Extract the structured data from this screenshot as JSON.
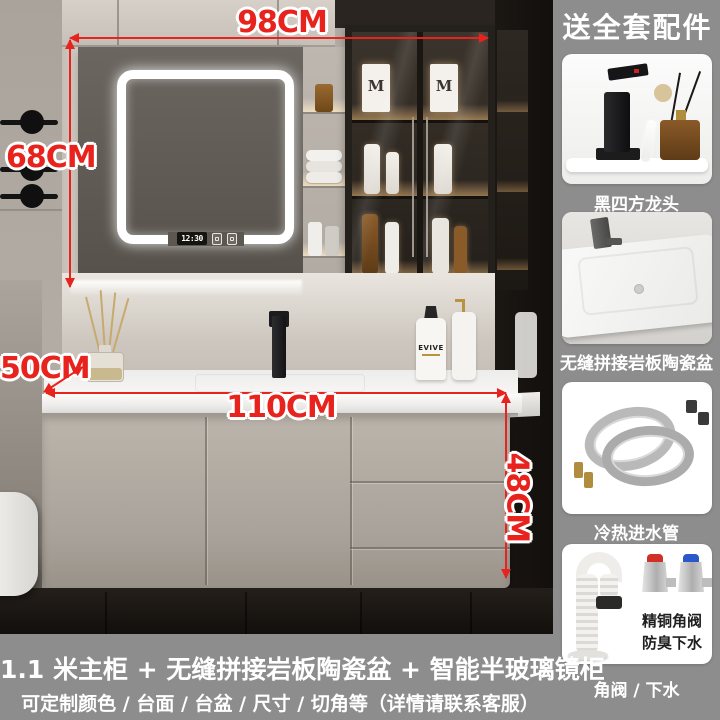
{
  "dimensions": {
    "top_width": "98CM",
    "mirror_height": "68CM",
    "counter_depth": "50CM",
    "counter_width": "110CM",
    "cabinet_height": "48CM"
  },
  "mirror": {
    "clock_time": "12:30"
  },
  "products": {
    "box_logo": "M",
    "bottle_brand": "EVIVE"
  },
  "sidebar": {
    "header": "送全套配件",
    "items": [
      {
        "label": "黑四方龙头"
      },
      {
        "label": "无缝拼接岩板陶瓷盆"
      },
      {
        "label": "冷热进水管"
      },
      {
        "label": "角阀 / 下水",
        "badge_line1": "精铜角阀",
        "badge_line2": "防臭下水"
      }
    ]
  },
  "footer": {
    "title": "1.1 米主柜 + 无缝拼接岩板陶瓷盆 + 智能半玻璃镜柜",
    "subtitle": "可定制颜色 / 台面 / 台盆 / 尺寸 / 切角等（详情请联系客服）"
  },
  "colors": {
    "annotation_red": "#e8231d",
    "panel_gray": "#8d8d8d"
  }
}
